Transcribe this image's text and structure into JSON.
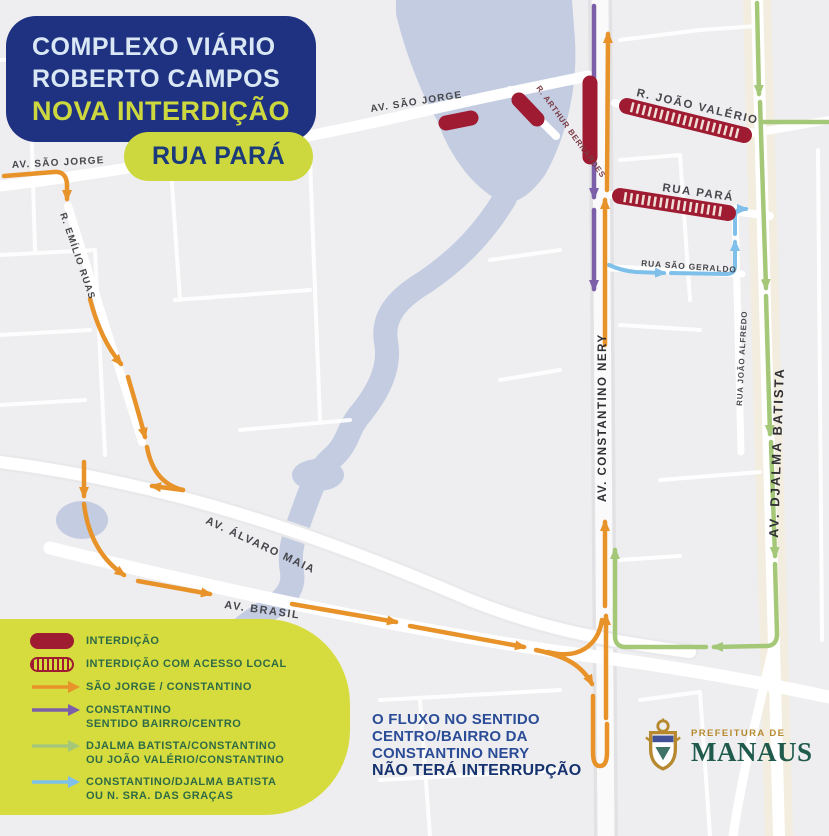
{
  "title": {
    "line1": "COMPLEXO VIÁRIO",
    "line2": "ROBERTO CAMPOS",
    "line3": "NOVA INTERDIÇÃO"
  },
  "badge": {
    "label": "RUA PARÁ"
  },
  "legend": {
    "items": [
      {
        "swatch": "pill-solid",
        "line1": "INTERDIÇÃO",
        "line2": ""
      },
      {
        "swatch": "pill-hatched",
        "line1": "INTERDIÇÃO COM ACESSO LOCAL",
        "line2": ""
      },
      {
        "swatch": "arrow-orange",
        "line1": "SÃO JORGE / CONSTANTINO",
        "line2": ""
      },
      {
        "swatch": "arrow-purple",
        "line1": "CONSTANTINO",
        "line2": "SENTIDO BAIRRO/CENTRO"
      },
      {
        "swatch": "arrow-green",
        "line1": "DJALMA BATISTA/CONSTANTINO",
        "line2": "OU JOÃO VALÉRIO/CONSTANTINO"
      },
      {
        "swatch": "arrow-blue",
        "line1": "CONSTANTINO/DJALMA BATISTA",
        "line2": "OU N. SRA. DAS GRAÇAS"
      }
    ]
  },
  "notice": {
    "line1": "O FLUXO NO SENTIDO",
    "line2": "CENTRO/BAIRRO DA",
    "line3": "CONSTANTINO NERY",
    "line4": "NÃO TERÁ INTERRUPÇÃO"
  },
  "footer": {
    "org_small": "PREFEITURA DE",
    "org_big": "MANAUS"
  },
  "streets": {
    "sao_jorge_left": "AV. SÃO JORGE",
    "sao_jorge_mid": "AV. SÃO JORGE",
    "emilio_ruas": "R. EMÍLIO RUAS",
    "arthur_bernardes": "R. ARTHUR BERNARDES",
    "joao_valerio": "R. JOÃO VALÉRIO",
    "rua_para": "RUA PARÁ",
    "sao_geraldo": "RUA SÃO GERALDO",
    "joao_alfredo": "RUA JOÃO ALFREDO",
    "djalma_batista": "AV. DJALMA BATISTA",
    "constantino_nery": "AV. CONSTANTINO NERY",
    "alvaro_maia": "AV. ÁLVARO MAIA",
    "brasil": "AV. BRASIL"
  },
  "colors": {
    "navy": "#1F3282",
    "lime": "#CDD83F",
    "crimson": "#9E1B32",
    "orange": "#E8922A",
    "purple": "#7C5FA9",
    "green": "#A5C878",
    "blue": "#7FC0EA",
    "water": "#C3CCE1",
    "legend_text": "#2E6B45",
    "street_label": "#47474C",
    "street_label_red": "#7C3A44",
    "notice_text": "#2B4C97",
    "notice_bold": "#16336F",
    "manaus_green": "#1F5A4C",
    "manaus_gold": "#B6892F"
  }
}
